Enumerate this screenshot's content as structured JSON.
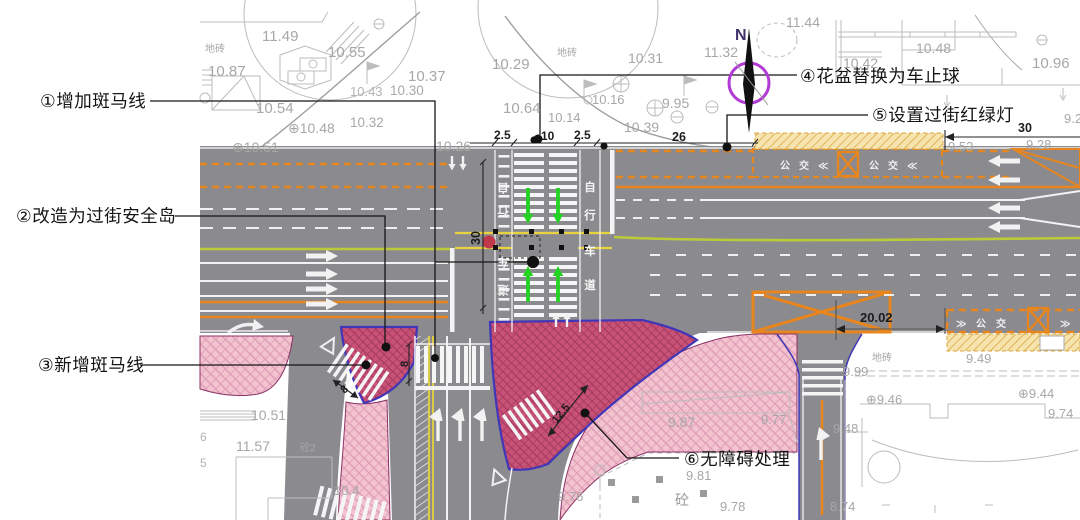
{
  "title": "交叉口交通改善工程平面图",
  "callouts": {
    "c1": "①增加斑马线",
    "c2": "②改造为过街安全岛",
    "c3": "③新增斑马线",
    "c4": "④花盆替换为车止球",
    "c5": "⑤设置过街红绿灯",
    "c6": "⑥无障碍处理"
  },
  "compass": {
    "north": "N"
  },
  "dims": {
    "g1": "2.5",
    "g2": "10",
    "g3": "2.5",
    "g4": "26",
    "g5": "30",
    "g6": "30",
    "g7": "20.02",
    "g8": "8",
    "g9": "8",
    "g10": "12.5"
  },
  "marks": {
    "bike1": "自",
    "bike2": "行",
    "bike3": "车",
    "bike4": "道",
    "tile": "地砖",
    "conc": "砼",
    "conc2": "砼2",
    "bus_a": "公",
    "bus_b": "交",
    "bus_l": "≪",
    "bus_r": "≫"
  },
  "elev": [
    "11.49",
    "10.55",
    "10.87",
    "10.54",
    "⊕10.48",
    "⊕10.51",
    "10.37",
    "10.43",
    "10.30",
    "10.32",
    "10.29",
    "10.64",
    "10.14",
    "10.16",
    "9.95",
    "10.31",
    "10.39",
    "10.26",
    "11.32",
    "11.44",
    "10.48",
    "10.42",
    "10.96",
    "9.2",
    "9.53",
    "9.28",
    "9.99",
    "9.48",
    "8.74",
    "9.87",
    "9.77",
    "9.81",
    "9.78",
    "9.76",
    "10.51",
    "11.57",
    "10.4",
    "⊕9.46",
    "⊕9.44",
    "9.74",
    "9.49",
    "6",
    "5"
  ],
  "colors": {
    "road": "#8b8b8f",
    "island_fill": "#c95277",
    "island_edge": "#4036b8",
    "sidewalk_pink": "#f3c3d0",
    "bus_zone_yellow": "#f6e3ae",
    "marking_orange": "#e8851c",
    "marking_yellow": "#e8d23f",
    "bike_separator_green": "#bacb37",
    "crossing_arrow_green": "#22d322",
    "compass_ring": "#b13bd4"
  }
}
